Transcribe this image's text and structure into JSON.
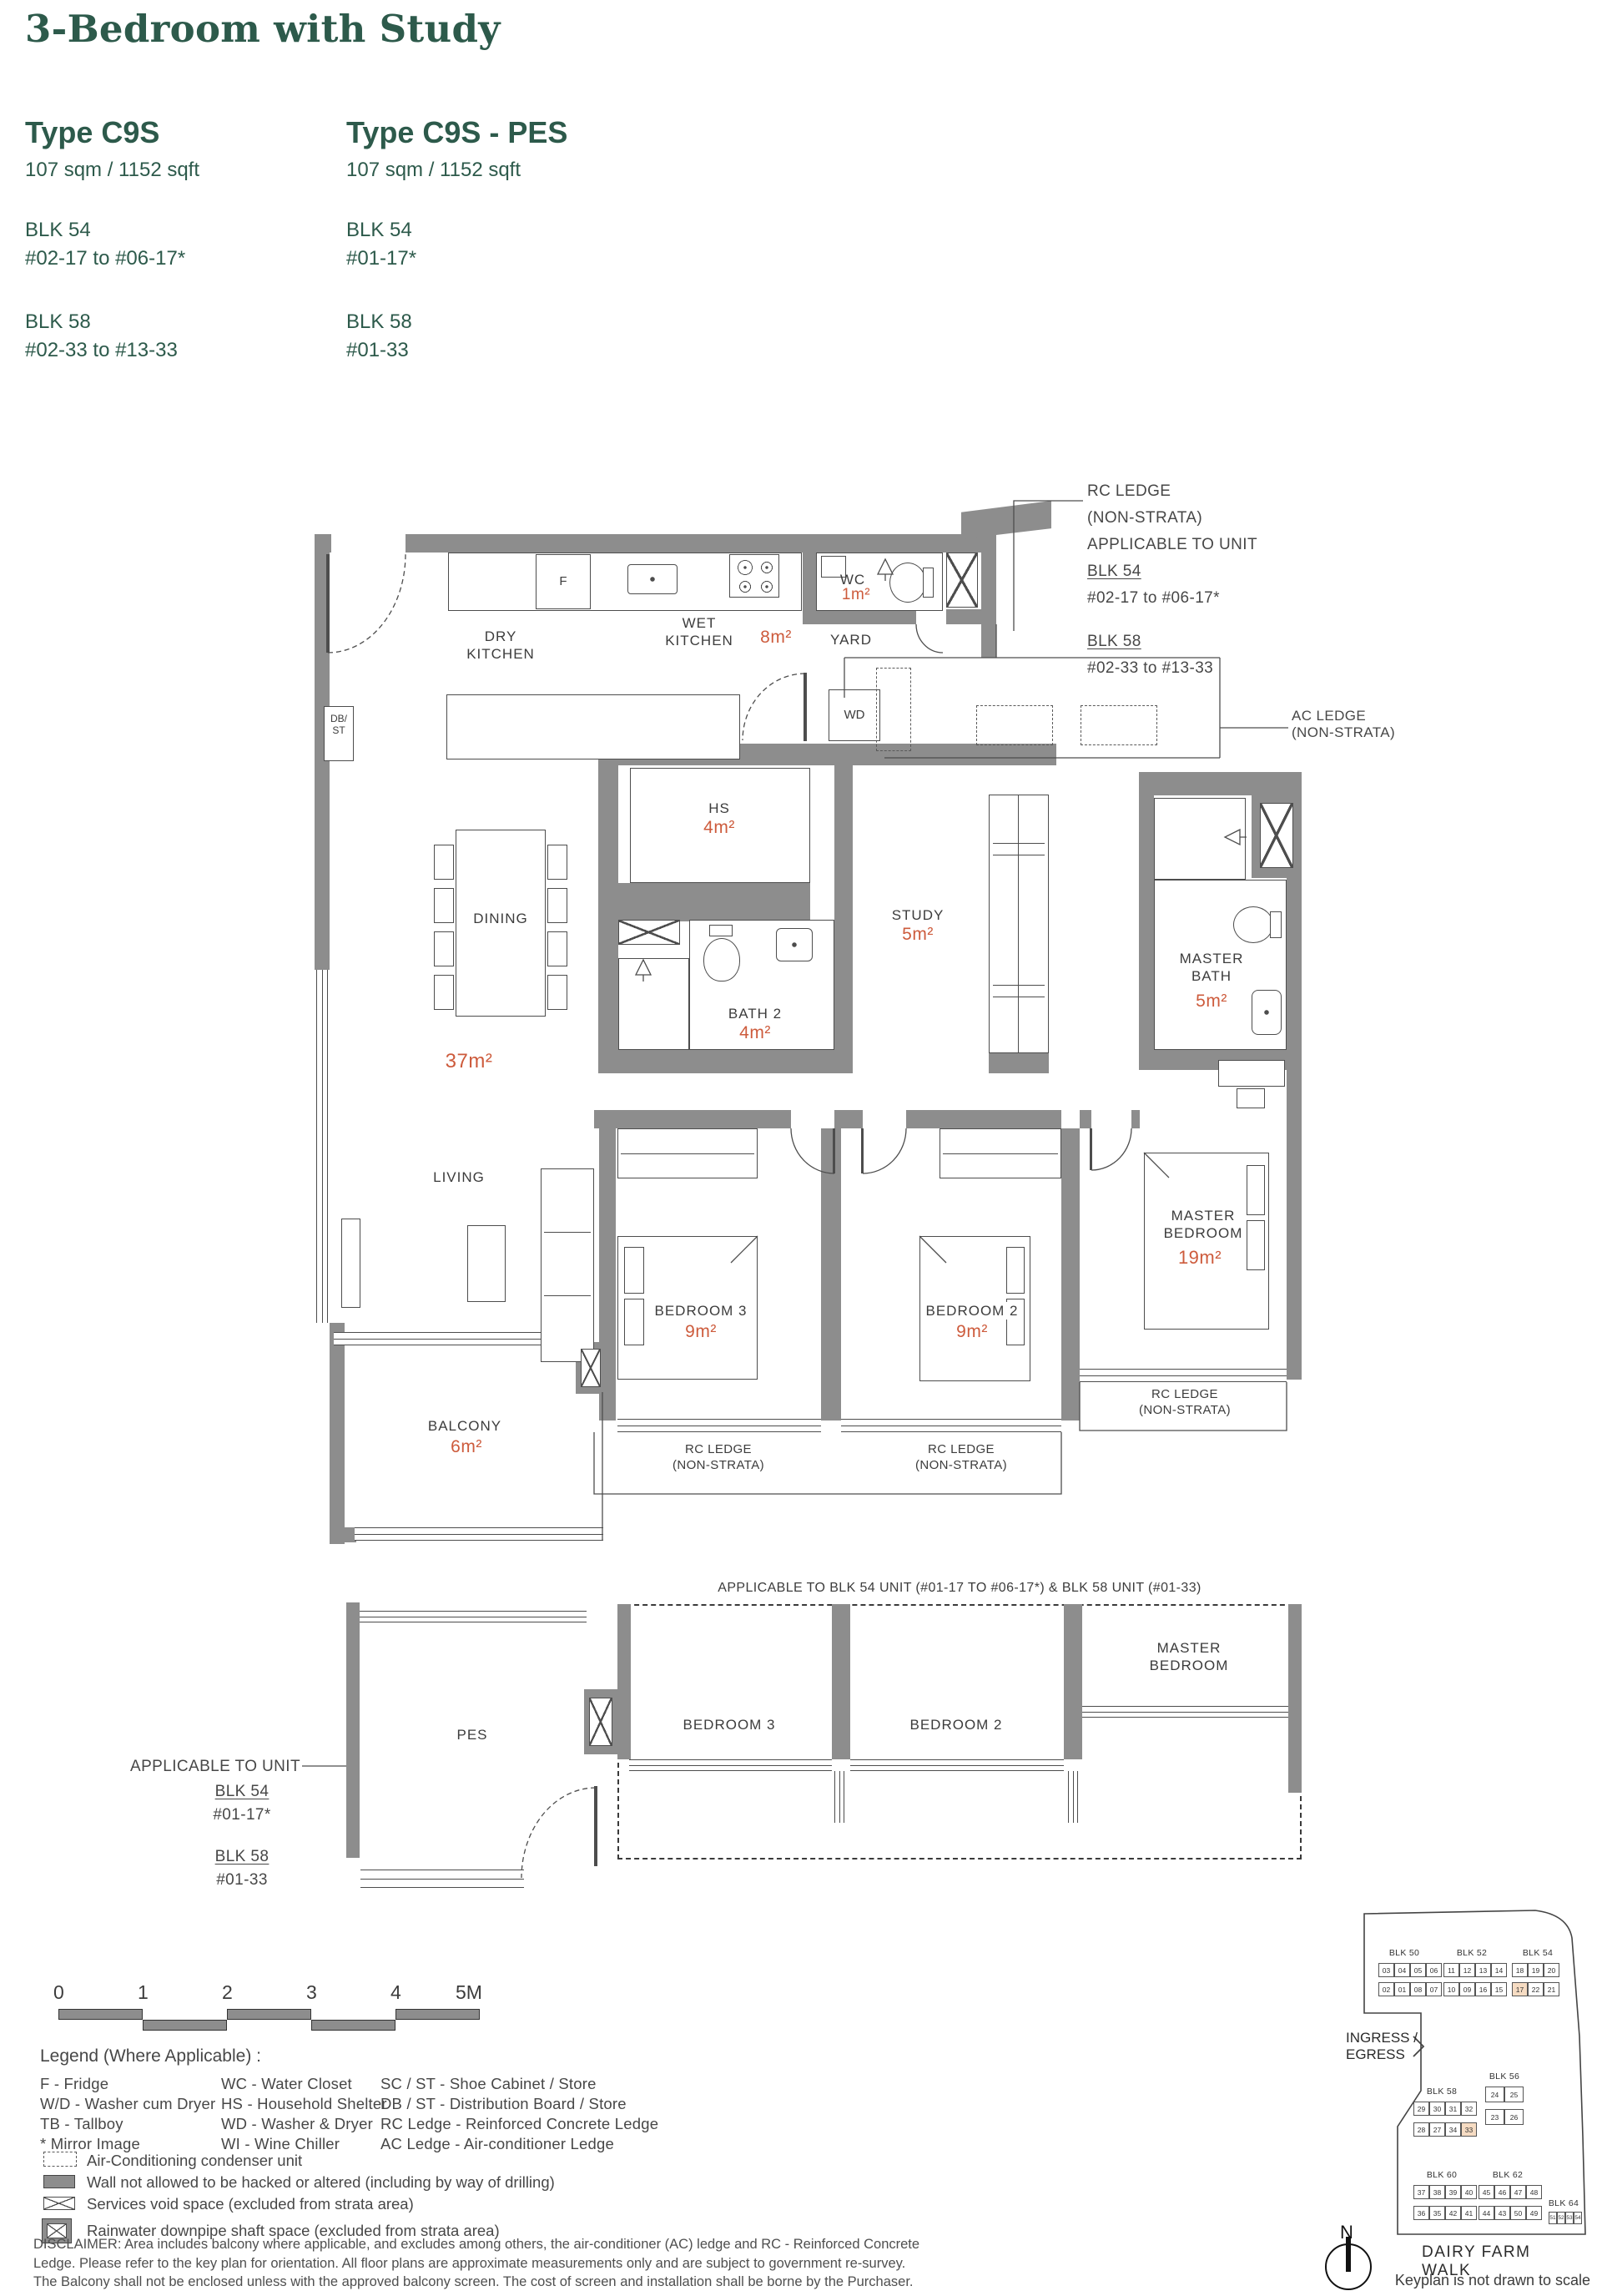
{
  "colors": {
    "green": "#2d5a4b",
    "orange": "#cd5b3c",
    "wall": "#8d8d8d",
    "line": "#4d4d4d",
    "highlight": "#f6dcc3"
  },
  "header": {
    "title": "3-Bedroom with Study",
    "types": [
      {
        "name": "Type C9S",
        "area": "107 sqm / 1152 sqft",
        "blocks": [
          {
            "blk": "BLK 54",
            "units": "#02-17 to #06-17*"
          },
          {
            "blk": "BLK 58",
            "units": "#02-33 to #13-33"
          }
        ]
      },
      {
        "name": "Type C9S - PES",
        "area": "107 sqm / 1152 sqft",
        "blocks": [
          {
            "blk": "BLK 54",
            "units": "#01-17*"
          },
          {
            "blk": "BLK 58",
            "units": "#01-33"
          }
        ]
      }
    ]
  },
  "plan": {
    "rooms": {
      "dry_kitchen": "DRY\nKITCHEN",
      "wet_kitchen": "WET\nKITCHEN",
      "wet_kitchen_area": "8m²",
      "wc": "WC",
      "wc_area": "1m²",
      "yard": "YARD",
      "hs": "HS",
      "hs_area": "4m²",
      "dining": "DINING",
      "bath2": "BATH 2",
      "bath2_area": "4m²",
      "study": "STUDY",
      "study_area": "5m²",
      "master_bath": "MASTER\nBATH",
      "master_bath_area": "5m²",
      "living": "LIVING",
      "living_area": "37m²",
      "bedroom3": "BEDROOM 3",
      "bedroom3_area": "9m²",
      "bedroom2": "BEDROOM 2",
      "bedroom2_area": "9m²",
      "master_bedroom": "MASTER\nBEDROOM",
      "master_bedroom_area": "19m²",
      "balcony": "BALCONY",
      "balcony_area": "6m²"
    },
    "fixtures": {
      "fridge": "F",
      "washer_dryer": "WD",
      "db_st": "DB/\nST"
    },
    "rc_ledge": "RC LEDGE\n(NON-STRATA)",
    "rc_annotation": {
      "l1": "RC LEDGE",
      "l2": "(NON-STRATA)",
      "l3": "APPLICABLE TO UNIT",
      "blk1": "BLK 54",
      "blk1_units": "#02-17 to #06-17*",
      "blk2": "BLK 58",
      "blk2_units": "#02-33 to #13-33"
    },
    "ac_annotation": "AC LEDGE\n(NON-STRATA)"
  },
  "pes": {
    "caption": "APPLICABLE TO BLK 54 UNIT (#01-17 TO #06-17*) & BLK 58 UNIT (#01-33)",
    "annotation": {
      "l1": "APPLICABLE TO UNIT",
      "blk1": "BLK 54",
      "blk1_units": "#01-17*",
      "blk2": "BLK 58",
      "blk2_units": "#01-33"
    },
    "rooms": {
      "pes": "PES",
      "bedroom3": "BEDROOM 3",
      "bedroom2": "BEDROOM 2",
      "master_bedroom": "MASTER\nBEDROOM"
    }
  },
  "scale_bar": {
    "labels": [
      "0",
      "1",
      "2",
      "3",
      "4",
      "5M"
    ]
  },
  "legend": {
    "title": "Legend (Where Applicable) :",
    "columns": [
      [
        "F - Fridge",
        "W/D - Washer cum Dryer",
        "TB - Tallboy",
        "* Mirror Image"
      ],
      [
        "WC - Water Closet",
        "HS - Household Shelter",
        "WD - Washer & Dryer",
        "WI - Wine Chiller"
      ],
      [
        "SC / ST - Shoe Cabinet / Store",
        "DB / ST - Distribution Board / Store",
        "RC Ledge - Reinforced Concrete Ledge",
        "AC Ledge - Air-conditioner Ledge"
      ]
    ],
    "symbols": [
      {
        "icon": "ac-condenser",
        "label": "Air-Conditioning condenser unit"
      },
      {
        "icon": "wall",
        "label": "Wall not allowed to be hacked or altered (including by way of drilling)"
      },
      {
        "icon": "services-void",
        "label": "Services void space (excluded from strata area)"
      },
      {
        "icon": "rainwater-shaft",
        "label": "Rainwater downpipe shaft space (excluded from strata area)"
      }
    ]
  },
  "disclaimer": "DISCLAIMER: Area includes balcony where applicable, and excludes among others, the air-conditioner (AC) ledge and RC - Reinforced Concrete Ledge. Please refer to the key plan for orientation. All floor plans are approximate measurements only and are subject to government re-survey. The Balcony shall not be enclosed unless with the approved balcony screen. The cost of screen and installation shall be borne by the Purchaser.",
  "keyplan": {
    "blocks": [
      {
        "name": "BLK 50",
        "rows": [
          [
            "03",
            "04",
            "05",
            "06"
          ],
          [
            "02",
            "01",
            "08",
            "07"
          ]
        ],
        "highlight": []
      },
      {
        "name": "BLK 52",
        "rows": [
          [
            "11",
            "12",
            "13",
            "14"
          ],
          [
            "10",
            "09",
            "16",
            "15"
          ]
        ],
        "highlight": []
      },
      {
        "name": "BLK 54",
        "rows": [
          [
            "18",
            "19",
            "20"
          ],
          [
            "17",
            "22",
            "21"
          ]
        ],
        "highlight": [
          "17"
        ]
      },
      {
        "name": "BLK 58",
        "rows": [
          [
            "29",
            "30",
            "31",
            "32"
          ],
          [
            "28",
            "27",
            "34",
            "33"
          ]
        ],
        "highlight": [
          "33"
        ]
      },
      {
        "name": "BLK 56",
        "rows": [
          [
            "24",
            "25"
          ],
          [
            "23",
            "26"
          ]
        ],
        "highlight": []
      },
      {
        "name": "BLK 60",
        "rows": [
          [
            "37",
            "38",
            "39",
            "40"
          ],
          [
            "36",
            "35",
            "42",
            "41"
          ]
        ],
        "highlight": []
      },
      {
        "name": "BLK 62",
        "rows": [
          [
            "45",
            "46",
            "47",
            "48"
          ],
          [
            "44",
            "43",
            "50",
            "49"
          ]
        ],
        "highlight": []
      },
      {
        "name": "BLK 64",
        "rows": [
          [
            "51",
            "52",
            "53",
            "54"
          ]
        ],
        "highlight": []
      }
    ],
    "ingress": "INGRESS /\nEGRESS",
    "road": "DAIRY FARM WALK",
    "north": "N",
    "note": "Keyplan is not drawn to scale"
  }
}
